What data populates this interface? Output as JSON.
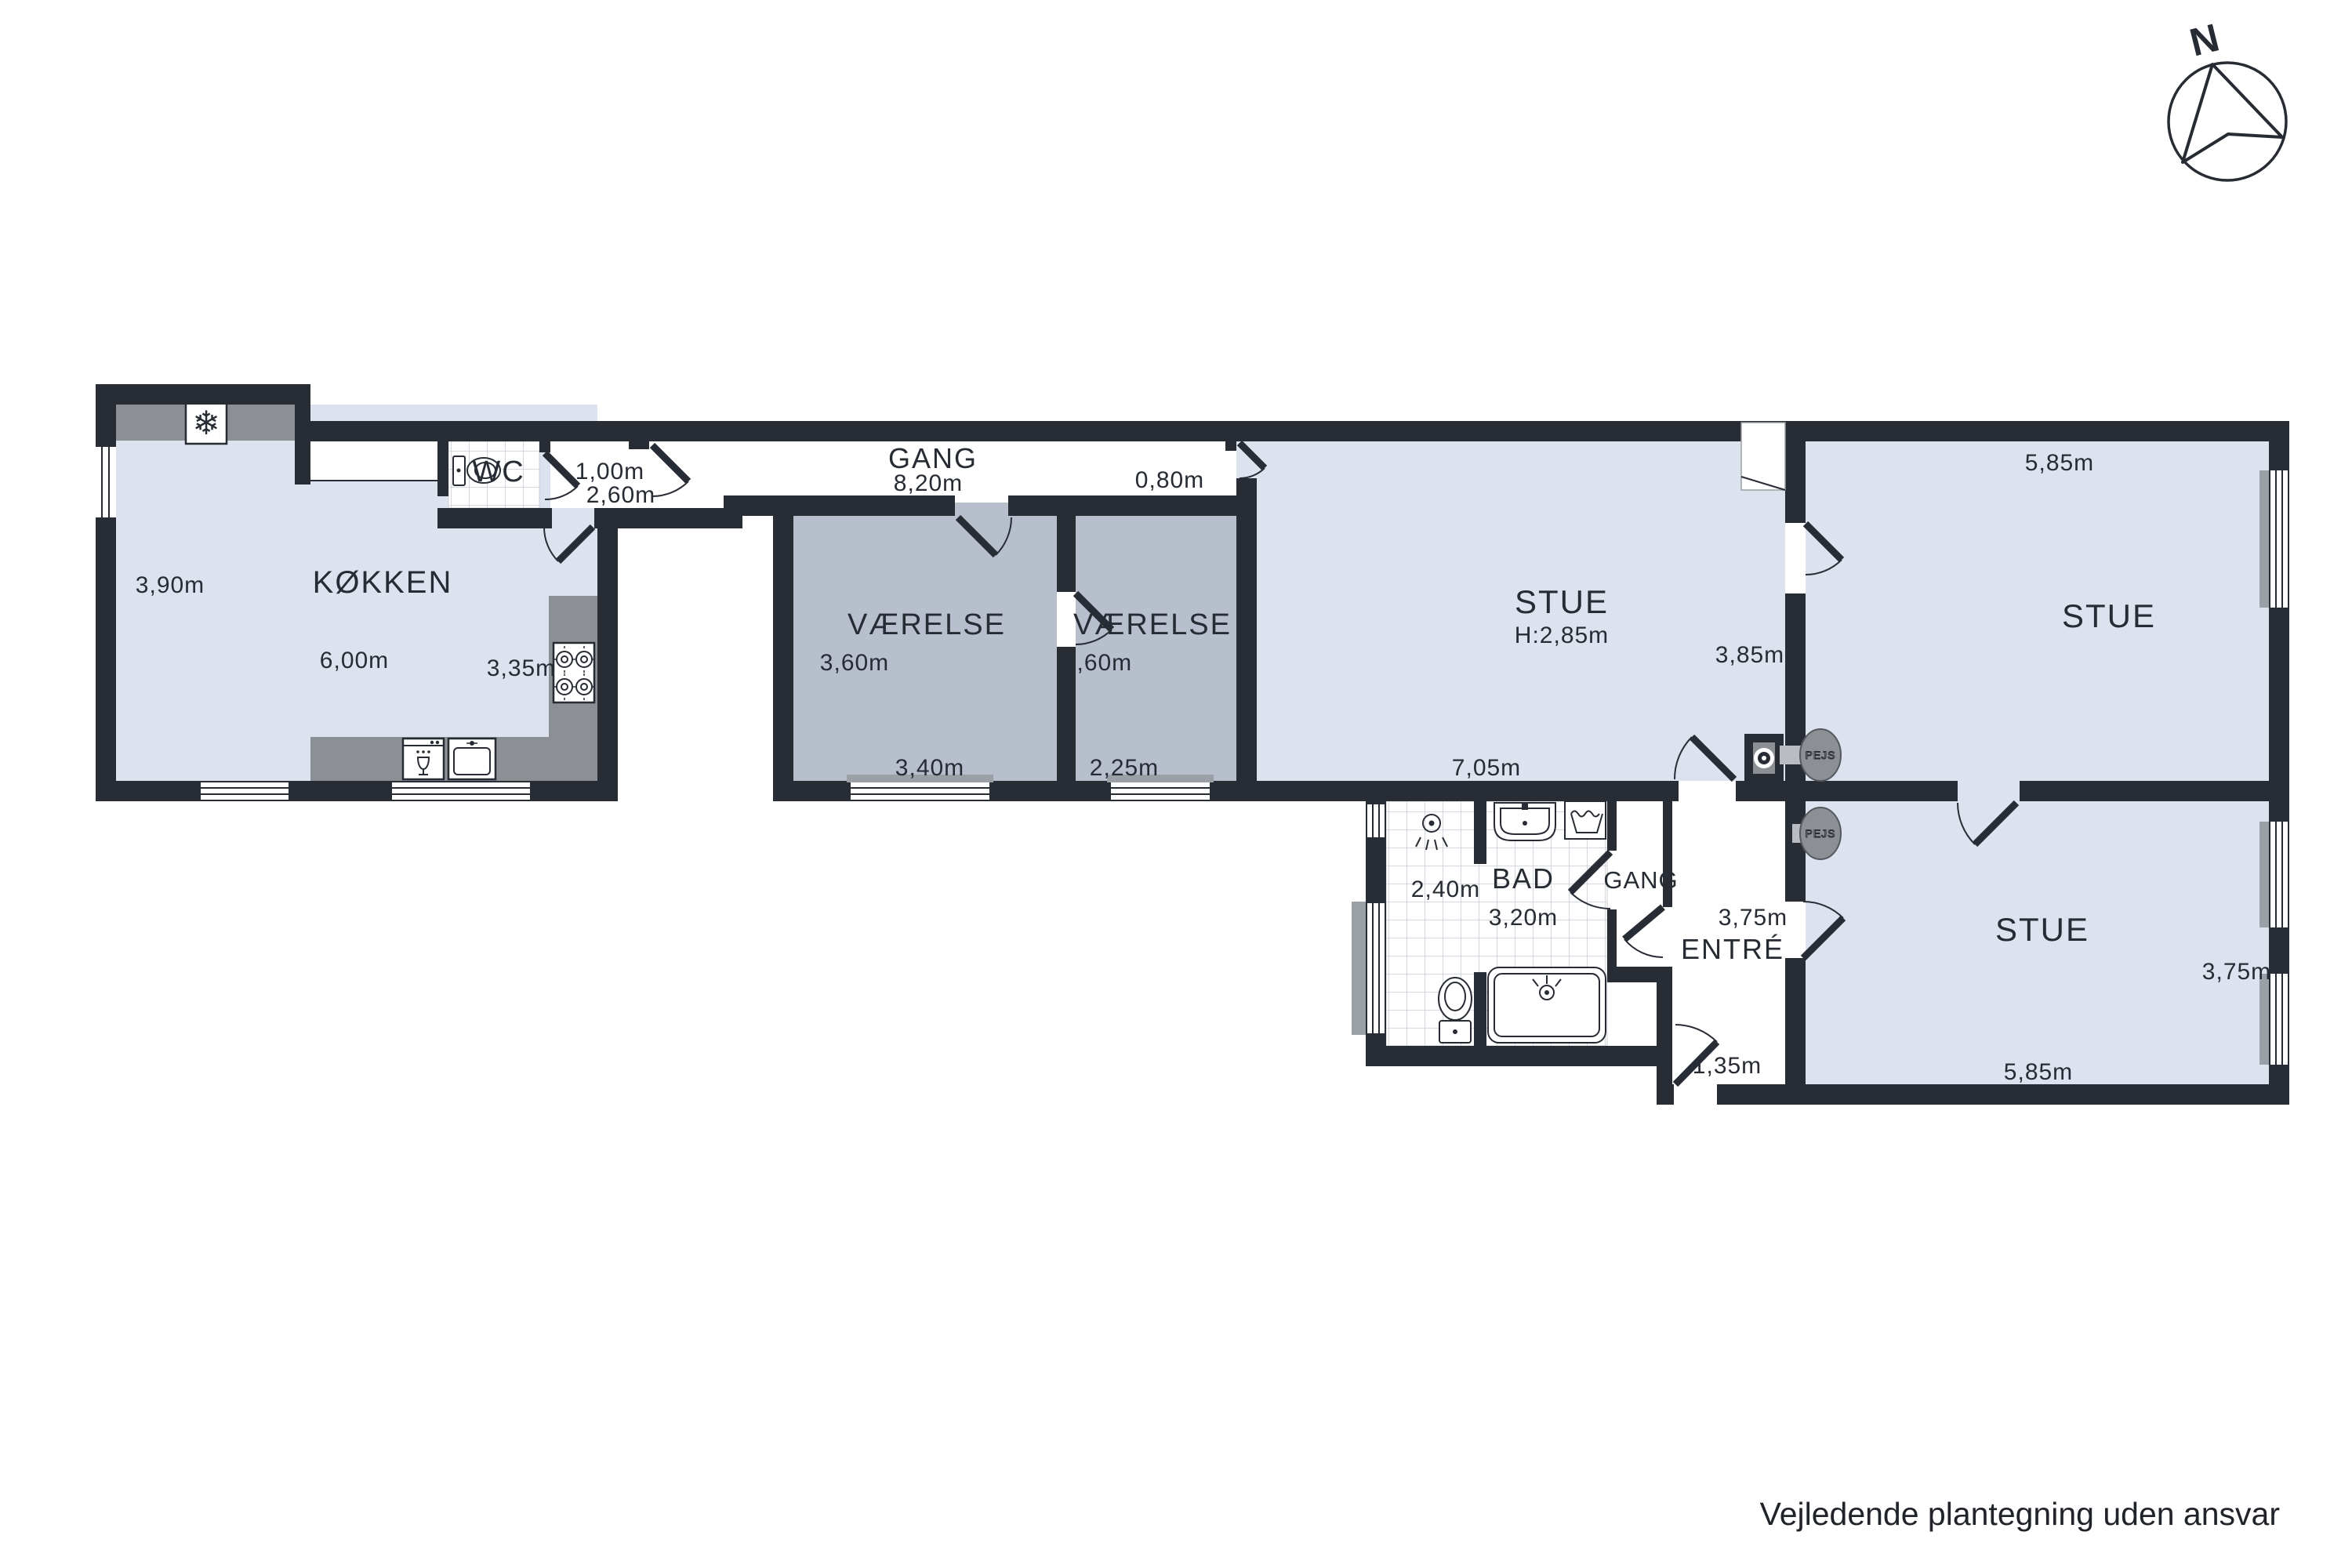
{
  "disclaimer": "Vejledende plantegning uden ansvar",
  "compass": {
    "north": "N"
  },
  "fireplace": {
    "label": "PEJS"
  },
  "icons": {
    "fridge": "❄"
  },
  "palette": {
    "wall": "#282d35",
    "room_light": "#dde3ee",
    "room_gray": "#b7becc",
    "counter": "#8c9095",
    "sill": "#9aa0a6",
    "tile_line": "#c9ced6"
  },
  "rooms": {
    "kitchen": {
      "name": "KØKKEN",
      "dim_left": "3,90m",
      "dim_bottom": "6,00m",
      "dim_right": "3,35m"
    },
    "wc": {
      "name": "WC",
      "dim1": "1,00m",
      "dim2": "2,60m"
    },
    "corridor": {
      "name": "GANG",
      "dim_length": "8,20m",
      "dim_end": "0,80m"
    },
    "bedroom1": {
      "name": "VÆRELSE",
      "dim_left": "3,60m",
      "dim_bottom": "3,40m"
    },
    "bedroom2": {
      "name": "VÆRELSE",
      "dim_left": "3,60m",
      "dim_bottom": "2,25m"
    },
    "living_main": {
      "name": "STUE",
      "ceiling_height": "H:2,85m",
      "dim_bottom": "7,05m",
      "dim_wall": "3,85m"
    },
    "living_ne": {
      "name": "STUE",
      "dim_top": "5,85m"
    },
    "living_se": {
      "name": "STUE",
      "dim_right": "3,75m",
      "dim_bottom": "5,85m"
    },
    "bath": {
      "name": "BAD",
      "dim_left": "2,40m",
      "dim_bottom": "3,20m"
    },
    "hallway": {
      "name": "GANG"
    },
    "entry": {
      "name": "ENTRÉ",
      "dim_top": "3,75m",
      "dim_door": "1,35m"
    }
  }
}
